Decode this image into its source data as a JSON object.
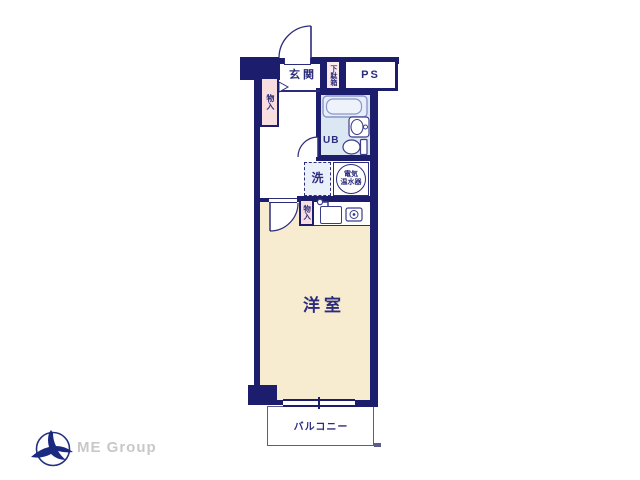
{
  "floor_plan": {
    "rooms": {
      "genkan": "玄関",
      "shoe_cabinet": "下駄箱",
      "pipe_space": "PS",
      "storage_upper": "物入",
      "unit_bath": "UB",
      "washer": "洗",
      "water_heater_line1": "電気",
      "water_heater_line2": "温水器",
      "storage_lower": "物入",
      "western_room": "洋室",
      "balcony": "バルコニー"
    },
    "icons": {
      "bathtub-icon": "unit bath tub outline",
      "basin-icon": "wash basin with faucet dot",
      "toilet-icon": "toilet bowl and tank",
      "kitchen-faucet-icon": "kitchen faucet pipe",
      "kitchen-sink-icon": "kitchen sink rectangle",
      "stove-icon": "single burner circle",
      "door-arc-icon": "door swing quarter arc",
      "window-icon": "sliding window double line",
      "step-marker-icon": "entrance step triangle",
      "bird-logo-icon": "swallow flying through circle"
    },
    "colors": {
      "wall_navy": "#1d1d6d",
      "text_navy": "#2c2c7c",
      "room_beige": "#f8ecd0",
      "storage_pink": "#f8dede",
      "shoe_pink": "#fbeaea",
      "bath_blue": "#dce7f4",
      "washer_blue": "#ebf1fb",
      "fixture_line": "#3c3c8c",
      "tub_line": "#8a96c8",
      "balcony_line": "#5c5c8a",
      "logo_gray": "#c8c8c8",
      "logo_navy": "#22307f"
    }
  },
  "branding": {
    "logo_text": "ME Group"
  }
}
